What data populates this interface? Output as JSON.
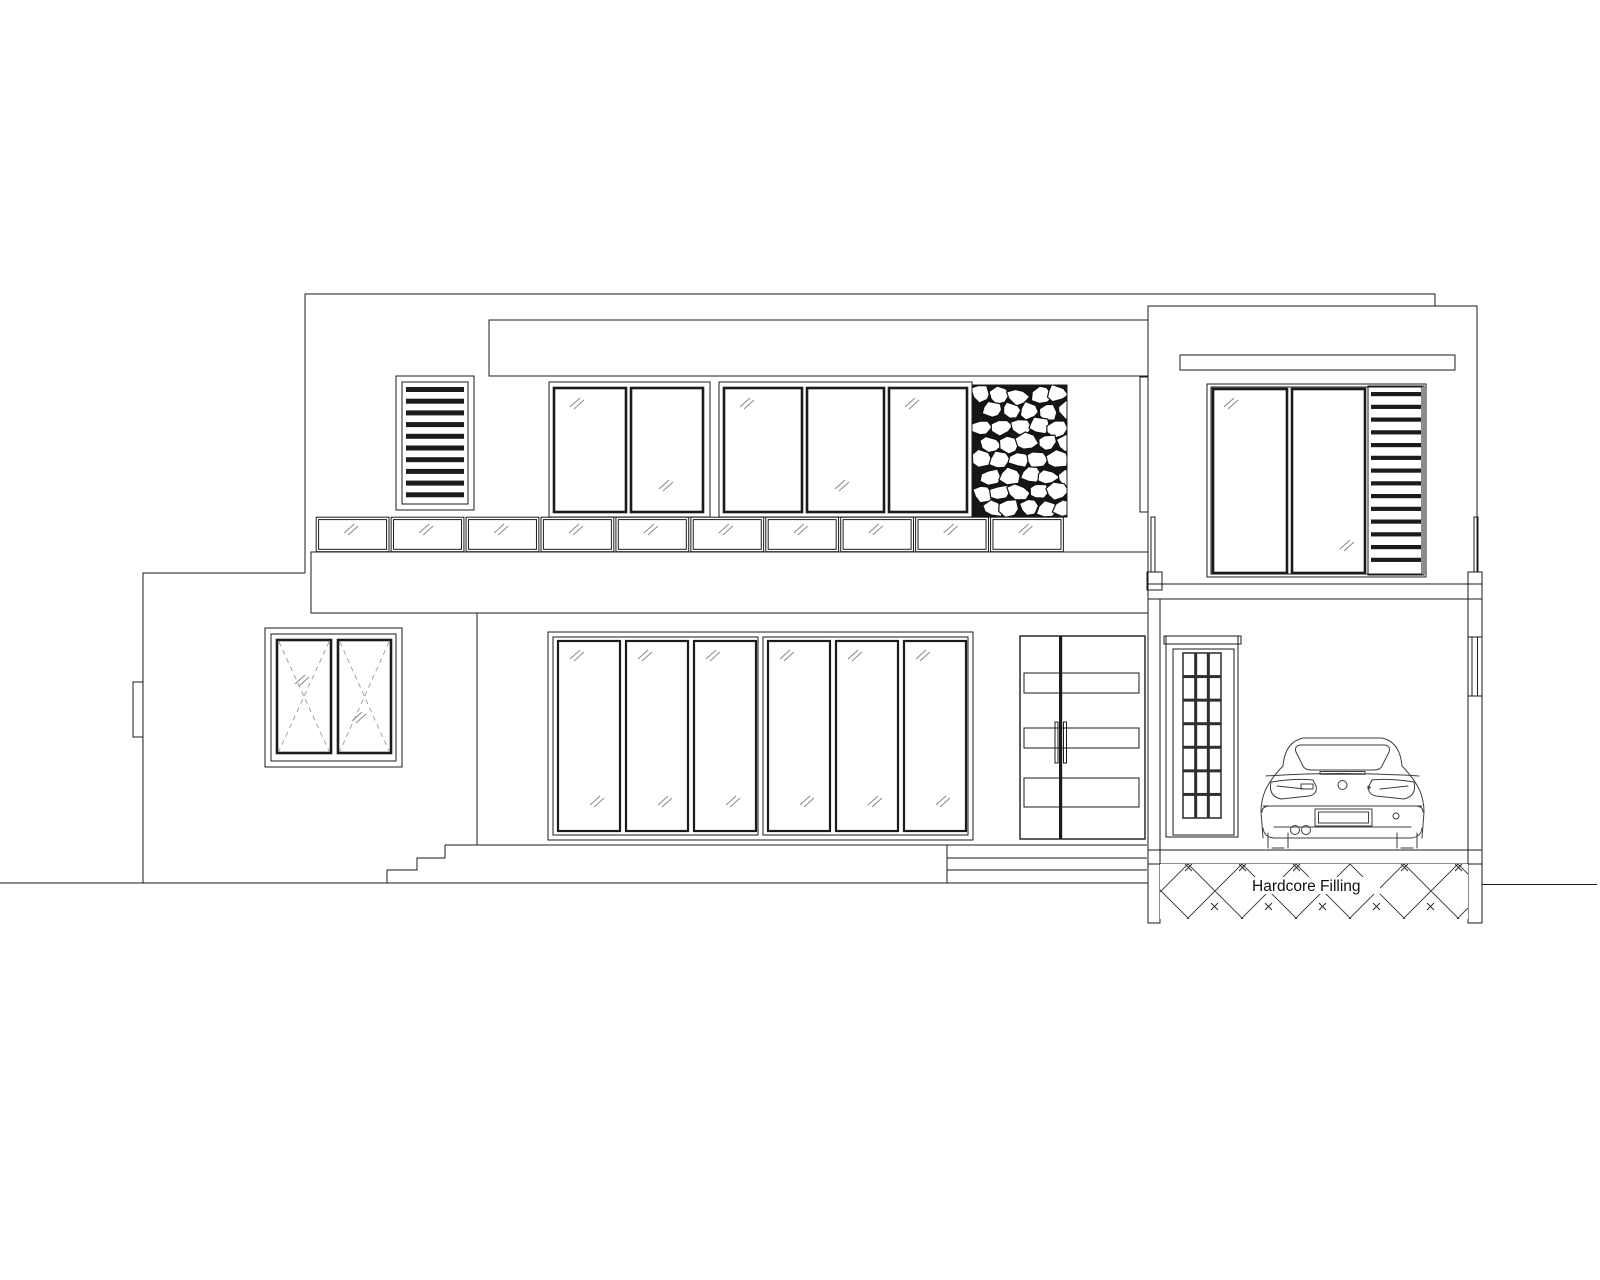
{
  "annotation": {
    "hardcore_filling": "Hardcore Filling"
  },
  "palette": {
    "line": "#1b1b1b",
    "background": "#ffffff",
    "glass_mark": "#8a8a8a"
  },
  "elevation": {
    "balcony_glass_panels": 10,
    "upper_floor_window_panes": 5,
    "ground_floor_window_panes": 6,
    "left_wing_window_casements": 2,
    "upper_louver_slats": 10,
    "garage_louver_slats": 14,
    "garage_window_panes": 2,
    "entry_door_glass_strips": 3,
    "garage_door_grid_columns": 3,
    "garage_door_grid_rows": 7,
    "left_step_count": 3,
    "right_step_count": 3
  }
}
